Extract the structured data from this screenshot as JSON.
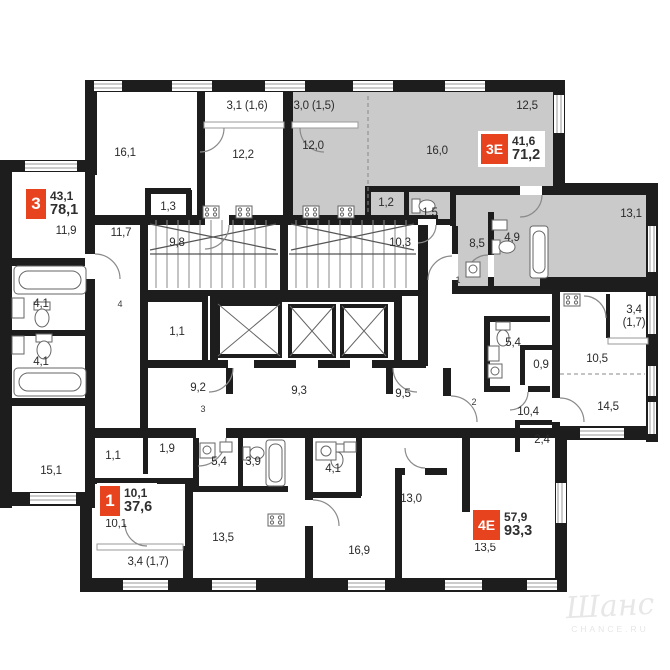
{
  "apartments": [
    {
      "tag": "3",
      "area_living": "43,1",
      "area_total": "78,1"
    },
    {
      "tag": "3Е",
      "area_living": "41,6",
      "area_total": "71,2"
    },
    {
      "tag": "1",
      "area_living": "10,1",
      "area_total": "37,6"
    },
    {
      "tag": "4Е",
      "area_living": "57,9",
      "area_total": "93,3"
    }
  ],
  "rooms": [
    {
      "label": "16,1"
    },
    {
      "label": "3,1 (1,6)"
    },
    {
      "label": "12,2"
    },
    {
      "label": "3,0 (1,5)"
    },
    {
      "label": "12,0"
    },
    {
      "label": "16,0"
    },
    {
      "label": "12,5"
    },
    {
      "label": "13,1"
    },
    {
      "label": "11,9"
    },
    {
      "label": "11,7"
    },
    {
      "label": "1,3"
    },
    {
      "label": "9,8"
    },
    {
      "label": "10,3"
    },
    {
      "label": "1,2"
    },
    {
      "label": "1,5"
    },
    {
      "label": "8,5"
    },
    {
      "label": "4,9"
    },
    {
      "label": "4,1"
    },
    {
      "label": "1,1"
    },
    {
      "label": "4,1"
    },
    {
      "label": "15,1"
    },
    {
      "label": "9,2"
    },
    {
      "label": "9,3"
    },
    {
      "label": "9,5"
    },
    {
      "label": "1,1"
    },
    {
      "label": "1,9"
    },
    {
      "label": "5,4"
    },
    {
      "label": "3,9"
    },
    {
      "label": "10,1"
    },
    {
      "label": "3,4 (1,7)"
    },
    {
      "label": "13,5"
    },
    {
      "label": "4,1"
    },
    {
      "label": "16,9"
    },
    {
      "label": "13,0"
    },
    {
      "label": "13,5"
    },
    {
      "label": "5,4"
    },
    {
      "label": "0,9"
    },
    {
      "label": "10,4"
    },
    {
      "label": "2,4"
    },
    {
      "label": "10,5"
    },
    {
      "label": "14,5"
    },
    {
      "label": "3,4"
    },
    {
      "label": "(1,7)"
    }
  ],
  "entry_numbers": [
    {
      "label": "1"
    },
    {
      "label": "2"
    },
    {
      "label": "3"
    },
    {
      "label": "4"
    }
  ],
  "watermark": {
    "script": "Шанс",
    "caption": "CHANCE.RU"
  },
  "colors": {
    "wall": "#1d1d1d",
    "apartment_gray": "#cacaca",
    "accent_red": "#e8431f"
  }
}
